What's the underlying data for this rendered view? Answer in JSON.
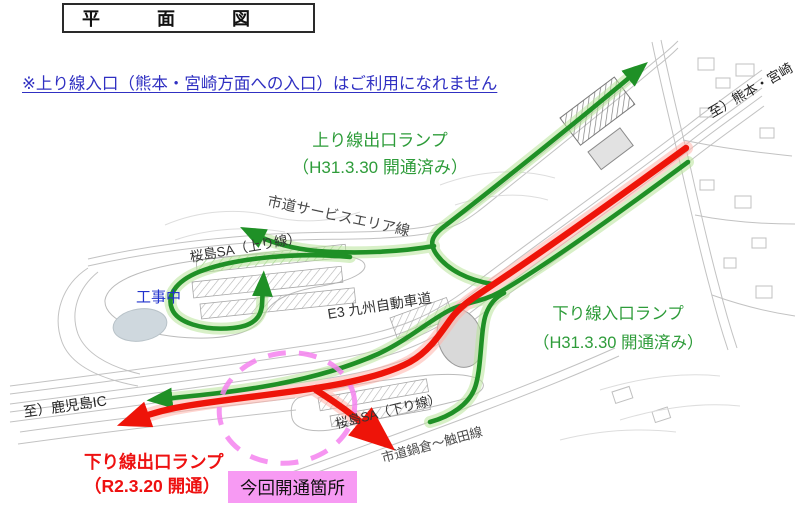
{
  "title": "平 面 図",
  "notice": "※上り線入口（熊本・宮崎方面への入口）はご利用になれません",
  "ramps": {
    "up_exit": {
      "line1": "上り線出口ランプ",
      "line2": "（H31.3.30 開通済み）"
    },
    "down_entrance": {
      "line1": "下り線入口ランプ",
      "line2": "（H31.3.30 開通済み）"
    },
    "down_exit": {
      "line1": "下り線出口ランプ",
      "line2": "（R2.3.20 開通）"
    }
  },
  "highlight": {
    "new_section_label": "今回開通箇所"
  },
  "map_labels": {
    "construction": "工事中",
    "expressway": "E3 九州自動車道",
    "sa_up_line": "桜島SA（上り線）",
    "sa_down_line": "桜島SA（下り線）",
    "service_area_road": "市道サービスエリア線",
    "nabekura_road": "市道鍋倉～触田線",
    "to_kumamoto_miyazaki": "至）熊本・宮崎",
    "to_kagoshima_ic": "至）鹿児島IC"
  },
  "colors": {
    "opened_route_green": "#1f9026",
    "new_route_red": "#ee1409",
    "highlight_magenta": "#f79af3",
    "notice_blue": "#3030c2",
    "green_text": "#2e9c3a",
    "red_text": "#ee1111",
    "construction_blue": "#2233cc"
  }
}
